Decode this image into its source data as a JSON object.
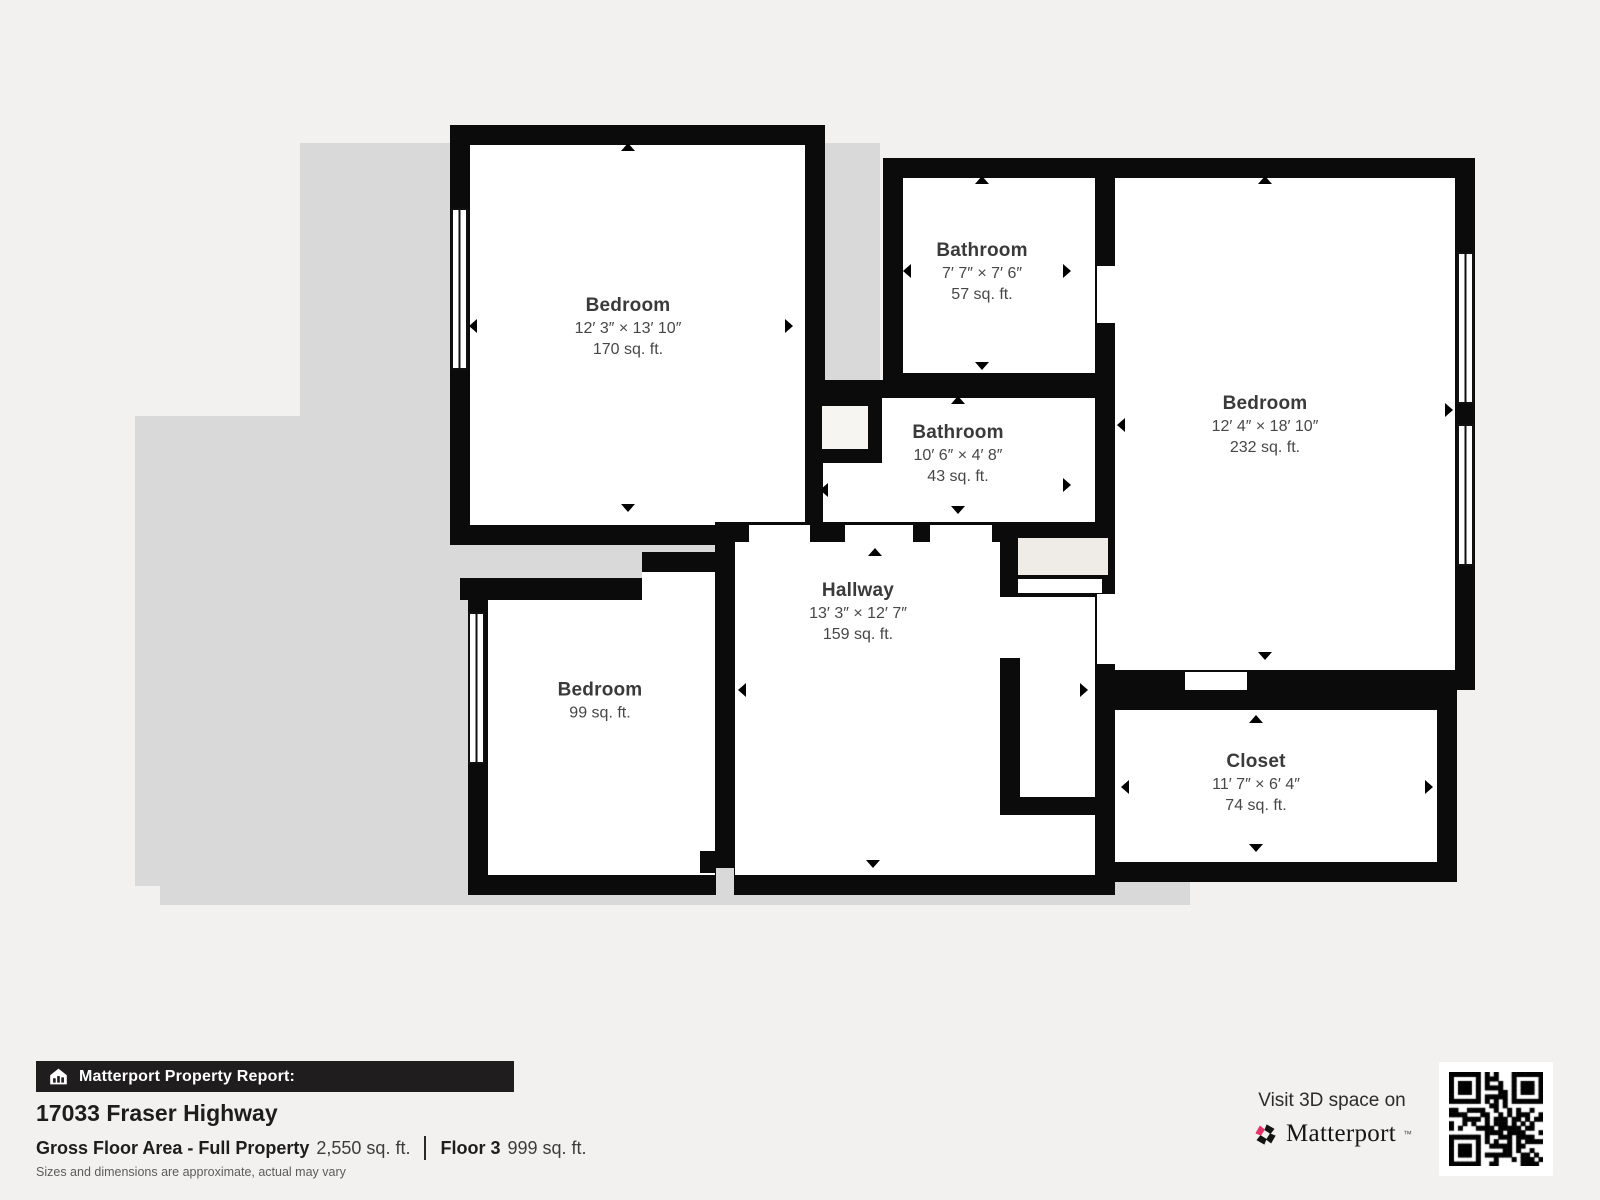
{
  "plan": {
    "rooms": [
      {
        "id": "bedroom-top-left",
        "name": "Bedroom",
        "dims": "12′ 3″ × 13′ 10″",
        "area": "170 sq. ft."
      },
      {
        "id": "bathroom-top",
        "name": "Bathroom",
        "dims": "7′ 7″ × 7′ 6″",
        "area": "57 sq. ft."
      },
      {
        "id": "bathroom-middle",
        "name": "Bathroom",
        "dims": "10′ 6″ × 4′ 8″",
        "area": "43 sq. ft."
      },
      {
        "id": "bedroom-right",
        "name": "Bedroom",
        "dims": "12′ 4″ × 18′ 10″",
        "area": "232 sq. ft."
      },
      {
        "id": "bedroom-bottom-left",
        "name": "Bedroom",
        "dims": "",
        "area": "99 sq. ft."
      },
      {
        "id": "hallway",
        "name": "Hallway",
        "dims": "13′ 3″ × 12′ 7″",
        "area": "159 sq. ft."
      },
      {
        "id": "closet",
        "name": "Closet",
        "dims": "11′ 7″ × 6′ 4″",
        "area": "74 sq. ft."
      }
    ]
  },
  "footer": {
    "report_label": "Matterport Property Report:",
    "address": "17033 Fraser Highway",
    "gross_label": "Gross Floor Area - Full Property",
    "gross_value": "2,550 sq. ft.",
    "floor_label": "Floor 3",
    "floor_value": "999 sq. ft.",
    "disclaimer": "Sizes and dimensions are approximate, actual may vary"
  },
  "branding": {
    "visit_text": "Visit 3D space on",
    "brand_name": "Matterport",
    "trademark": "™",
    "colors": {
      "accent_pink": "#e5336a",
      "wall_black": "#0b0b0b",
      "silhouette_gray": "#d9d9d9",
      "page_bg": "#f2f1ef"
    }
  }
}
